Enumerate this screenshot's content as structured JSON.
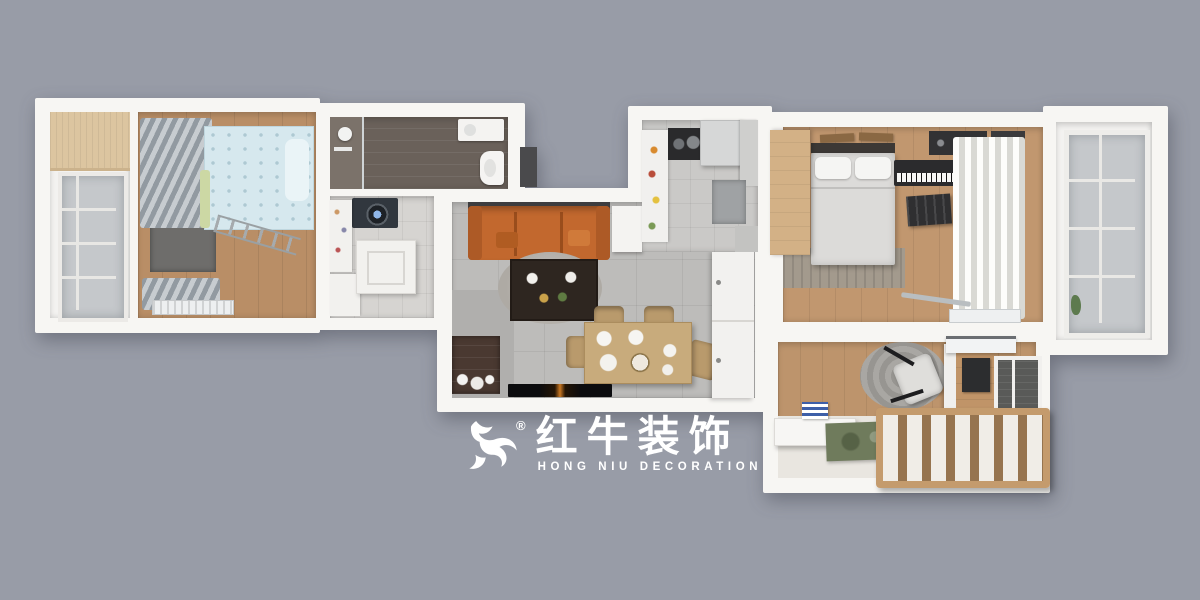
{
  "scene": {
    "description": "3D top-down rendered floor plan of a two-bedroom apartment on gray backdrop",
    "background_color": "#989ca7",
    "wall_color": "#f7f6f3"
  },
  "logo": {
    "icon": "red-bull-brush-swoosh",
    "registered_mark": "®",
    "brand_cn": "红牛装饰",
    "brand_en": "HONG NIU DECORATION",
    "color": "#ffffff"
  },
  "rooms": [
    {
      "id": "left-balcony",
      "label": "balcony",
      "features": [
        "wood-storage-cabinet",
        "glass-sliding-window"
      ]
    },
    {
      "id": "kids-bedroom",
      "label": "bedroom",
      "features": [
        "blue-patterned-bed",
        "green-headboard",
        "gray-curtains",
        "metal-ladder",
        "gray-desk",
        "radiator",
        "wood-floor"
      ]
    },
    {
      "id": "bathroom",
      "label": "bathroom",
      "features": [
        "shower",
        "vanity-sink",
        "toilet",
        "dark-plank-floor",
        "doorway"
      ]
    },
    {
      "id": "laundry-room",
      "label": "laundry room",
      "features": [
        "washing-machine",
        "storage-cabinets",
        "worktable",
        "tile-floor"
      ]
    },
    {
      "id": "living-dining-room",
      "label": "living / dining room",
      "features": [
        "orange-sofa",
        "white-side-table",
        "round-rug",
        "dark-coffee-table",
        "dining-table-with-4-chairs",
        "tv",
        "dark-tv-cabinet",
        "white-wardrobe",
        "gray-tile-floor"
      ]
    },
    {
      "id": "kitchen",
      "label": "kitchen",
      "features": [
        "fridge",
        "cooktop-hood",
        "white-counter",
        "gray-cabinets",
        "tile-floor"
      ]
    },
    {
      "id": "master-bedroom",
      "label": "master bedroom",
      "features": [
        "double-bed-white-bedding",
        "picture-frames",
        "wood-wardrobe",
        "keyboard-piano",
        "black-chair",
        "white-curtains",
        "gray-rug",
        "radiator",
        "wood-floor"
      ]
    },
    {
      "id": "right-balcony",
      "label": "balcony",
      "features": [
        "glass-windows",
        "plant"
      ]
    },
    {
      "id": "second-bedroom",
      "label": "bedroom",
      "features": [
        "white-desk",
        "book-stack",
        "green-rug",
        "round-knit-rug",
        "white-chair",
        "slatted-wood-bed-frame",
        "monitor-desk-unit",
        "ac-unit",
        "dark-window-panel",
        "wood-floor"
      ]
    }
  ],
  "palette": {
    "sofa_orange": "#c2682e",
    "bed_blue": "#d6e8ee",
    "wood_floor": "#bd946c",
    "tile_gray": "#bdbcba",
    "bathroom_floor": "#6a615a",
    "rug_green": "#6f7b5c",
    "curtain_gray": "#98a0a7",
    "coffee_table_dark": "#2e2620",
    "balcony_wood": "#dcc5a0"
  }
}
